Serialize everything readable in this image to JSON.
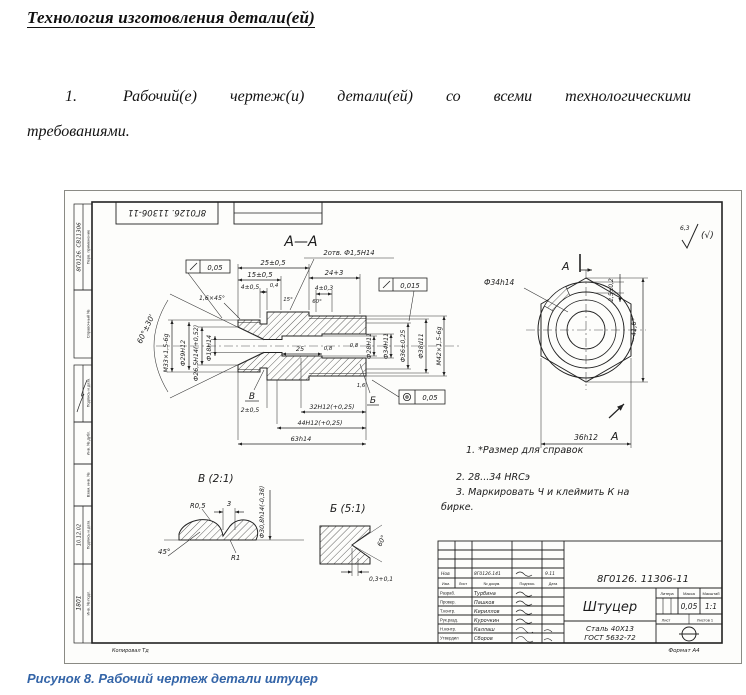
{
  "page": {
    "title": "Технология изготовления детали(ей)",
    "para_num": "1.",
    "para_line1": "Рабочий(е) чертеж(и) детали(ей) со всеми технологическими",
    "para_line2": "требованиями.",
    "caption": "Рисунок 8. Рабочий чертеж детали штуцер"
  },
  "drawing": {
    "top_stamp": "8Г0126. 11306-11",
    "roughness": {
      "value": "6,3",
      "suffix": "(√)"
    },
    "section_title": "А—А",
    "margin": {
      "perv_label": "Перв. применение",
      "perv_value": "8Г0126. СВ11306",
      "sprav": "Справочный №",
      "podpis1": "Подпись и дата",
      "inv_dubl": "Инв. № дубл.",
      "vzam": "Взам. инв. №",
      "podpis2": "Подпись и дата",
      "podpis2_value": "10.12.02",
      "inv_podl": "Инв. № подл.",
      "inv_podl_value": "1801"
    },
    "dims": {
      "d25_05": "25±0,5",
      "d15": "15±0,5",
      "d4_05": "4±0,5",
      "chamfer16": "1,6×45°",
      "holes": "2отв. Ф1,5Н14",
      "d24": "24+3",
      "d4_03": "4±0,3",
      "runout1": "0,05",
      "runout2": "0,015",
      "conc": "0,05",
      "cone_angle": "60°±30'",
      "m33": "М33×1,5-6g",
      "d29": "Ф29Н12",
      "d265": "Ф26,5Н14(+0,52)",
      "d18": "Ф18Н14",
      "d28": "Ф28Н11",
      "d34": "Ф34Н11",
      "d36": "Ф36±0,25",
      "d38": "Ф38d11",
      "m42": "М42×1,5-6g",
      "len25": "25",
      "ra08a": "0,8",
      "ra08b": "0,8",
      "ra04": "0,4",
      "ra16": "1,6",
      "len32": "32Н12(+0,25)",
      "len44": "44Н12(+0,25)",
      "len63": "63h14",
      "d2_05": "2±0,5",
      "ang15": "15°",
      "ang60": "60°",
      "flag_v": "В",
      "flag_b": "Б"
    },
    "hex_view": {
      "d34h": "Ф34h14",
      "d25_02": "2,5±0,2",
      "corners": "~41,6*",
      "flats": "36h12",
      "arrow_top": "А",
      "arrow_bottom": "А"
    },
    "notes": [
      "1. *Размер для справок",
      "2. 28...34 HRCэ",
      "3. Маркировать Ч и клеймить К на",
      "бирке."
    ],
    "detail_v": {
      "title": "В (2:1)",
      "r05": "R0,5",
      "w3": "3",
      "d308": "Ф30,8h14(-0,38)",
      "ang45": "45°",
      "r1": "R1"
    },
    "detail_b": {
      "title": "Б (5:1)",
      "ang60": "60°",
      "d03": "0,3+0,1"
    },
    "title_block": {
      "doc_number": "8Г0126. 11306-11",
      "part_name": "Штуцер",
      "material1": "Сталь 40X13",
      "material2": "ГОСТ 5632-72",
      "change_row": [
        "Нов",
        "8Г0126.141",
        "9.11"
      ],
      "header_row": [
        "Изм.",
        "Лист",
        "№ докум.",
        "Подпись",
        "Дата"
      ],
      "roles": [
        "Разраб.",
        "Провер.",
        "Т.контр.",
        "Рук.разд.",
        "Н.контр.",
        "Утвердил"
      ],
      "names": [
        "Турбина",
        "Пашков",
        "Кириллов",
        "Курочкин",
        "Каллаш",
        "Сборов"
      ],
      "litera": "Литера",
      "massa": "Масса",
      "masshtab": "Масштаб",
      "massa_value": "0,05",
      "scale_value": "1:1",
      "list": "Лист",
      "listov": "Листов 1",
      "format": "Формат А4",
      "copied": "Копировал Тд"
    }
  }
}
